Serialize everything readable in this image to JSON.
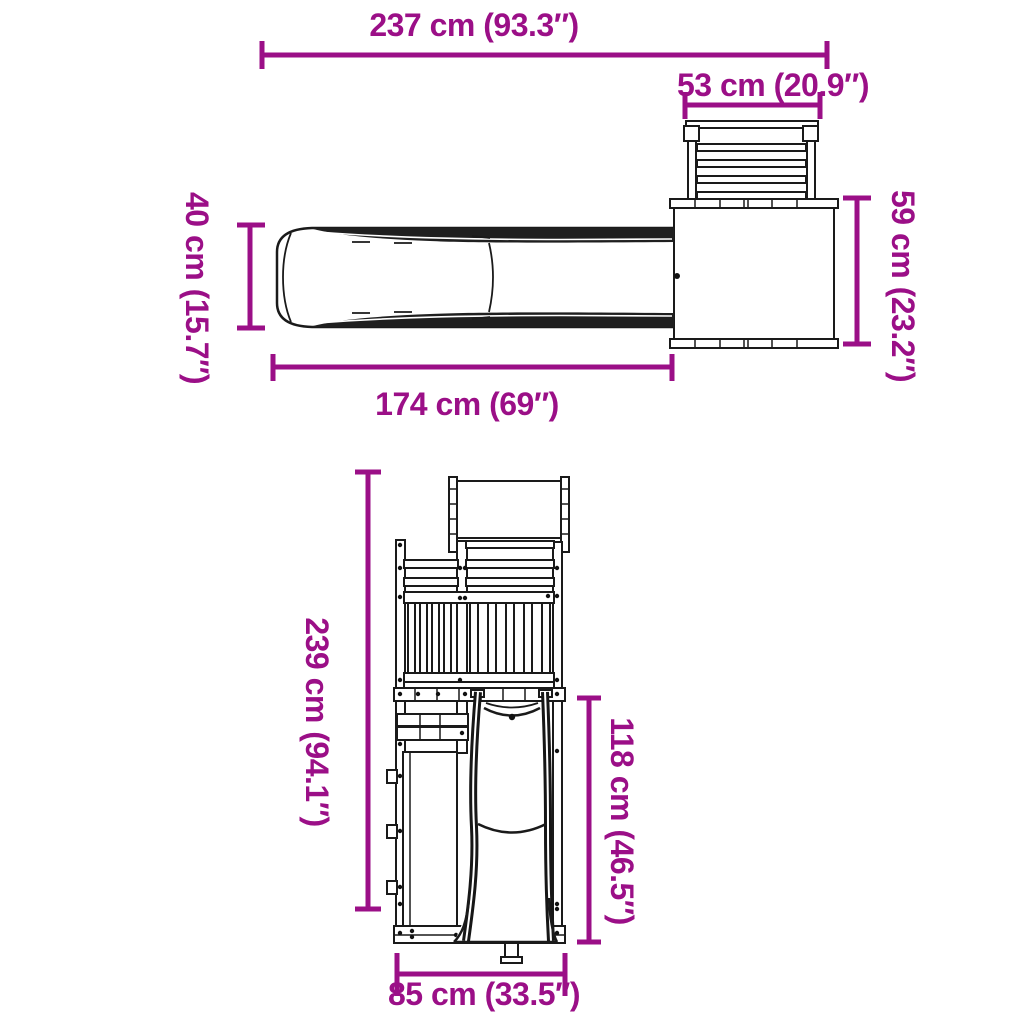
{
  "page": {
    "background_color": "#ffffff",
    "drawing_color": "#1a1a1a",
    "dimension_color": "#9b0f87"
  },
  "diagram": {
    "kind": "product-dimension-drawing",
    "subject": "outdoor wooden playset with slide and climbing wall",
    "views": [
      "top-view",
      "front-view"
    ]
  },
  "dims": {
    "d237": {
      "label": "237 cm (93.3″)",
      "measures": "overall-width",
      "view": "top",
      "orientation": "horizontal"
    },
    "d53": {
      "label": "53 cm (20.9″)",
      "measures": "climbing-wall-width",
      "view": "top",
      "orientation": "horizontal"
    },
    "d40": {
      "label": "40 cm (15.7″)",
      "measures": "slide-width",
      "view": "top",
      "orientation": "vertical"
    },
    "d59": {
      "label": "59 cm (23.2″)",
      "measures": "platform-depth",
      "view": "top",
      "orientation": "vertical"
    },
    "d174": {
      "label": "174 cm (69″)",
      "measures": "slide-length",
      "view": "top",
      "orientation": "horizontal"
    },
    "d239": {
      "label": "239 cm (94.1″)",
      "measures": "overall-height",
      "view": "front",
      "orientation": "vertical"
    },
    "d118": {
      "label": "118 cm (46.5″)",
      "measures": "platform-height",
      "view": "front",
      "orientation": "vertical"
    },
    "d85": {
      "label": "85 cm (33.5″)",
      "measures": "base-width",
      "view": "front",
      "orientation": "horizontal"
    }
  }
}
